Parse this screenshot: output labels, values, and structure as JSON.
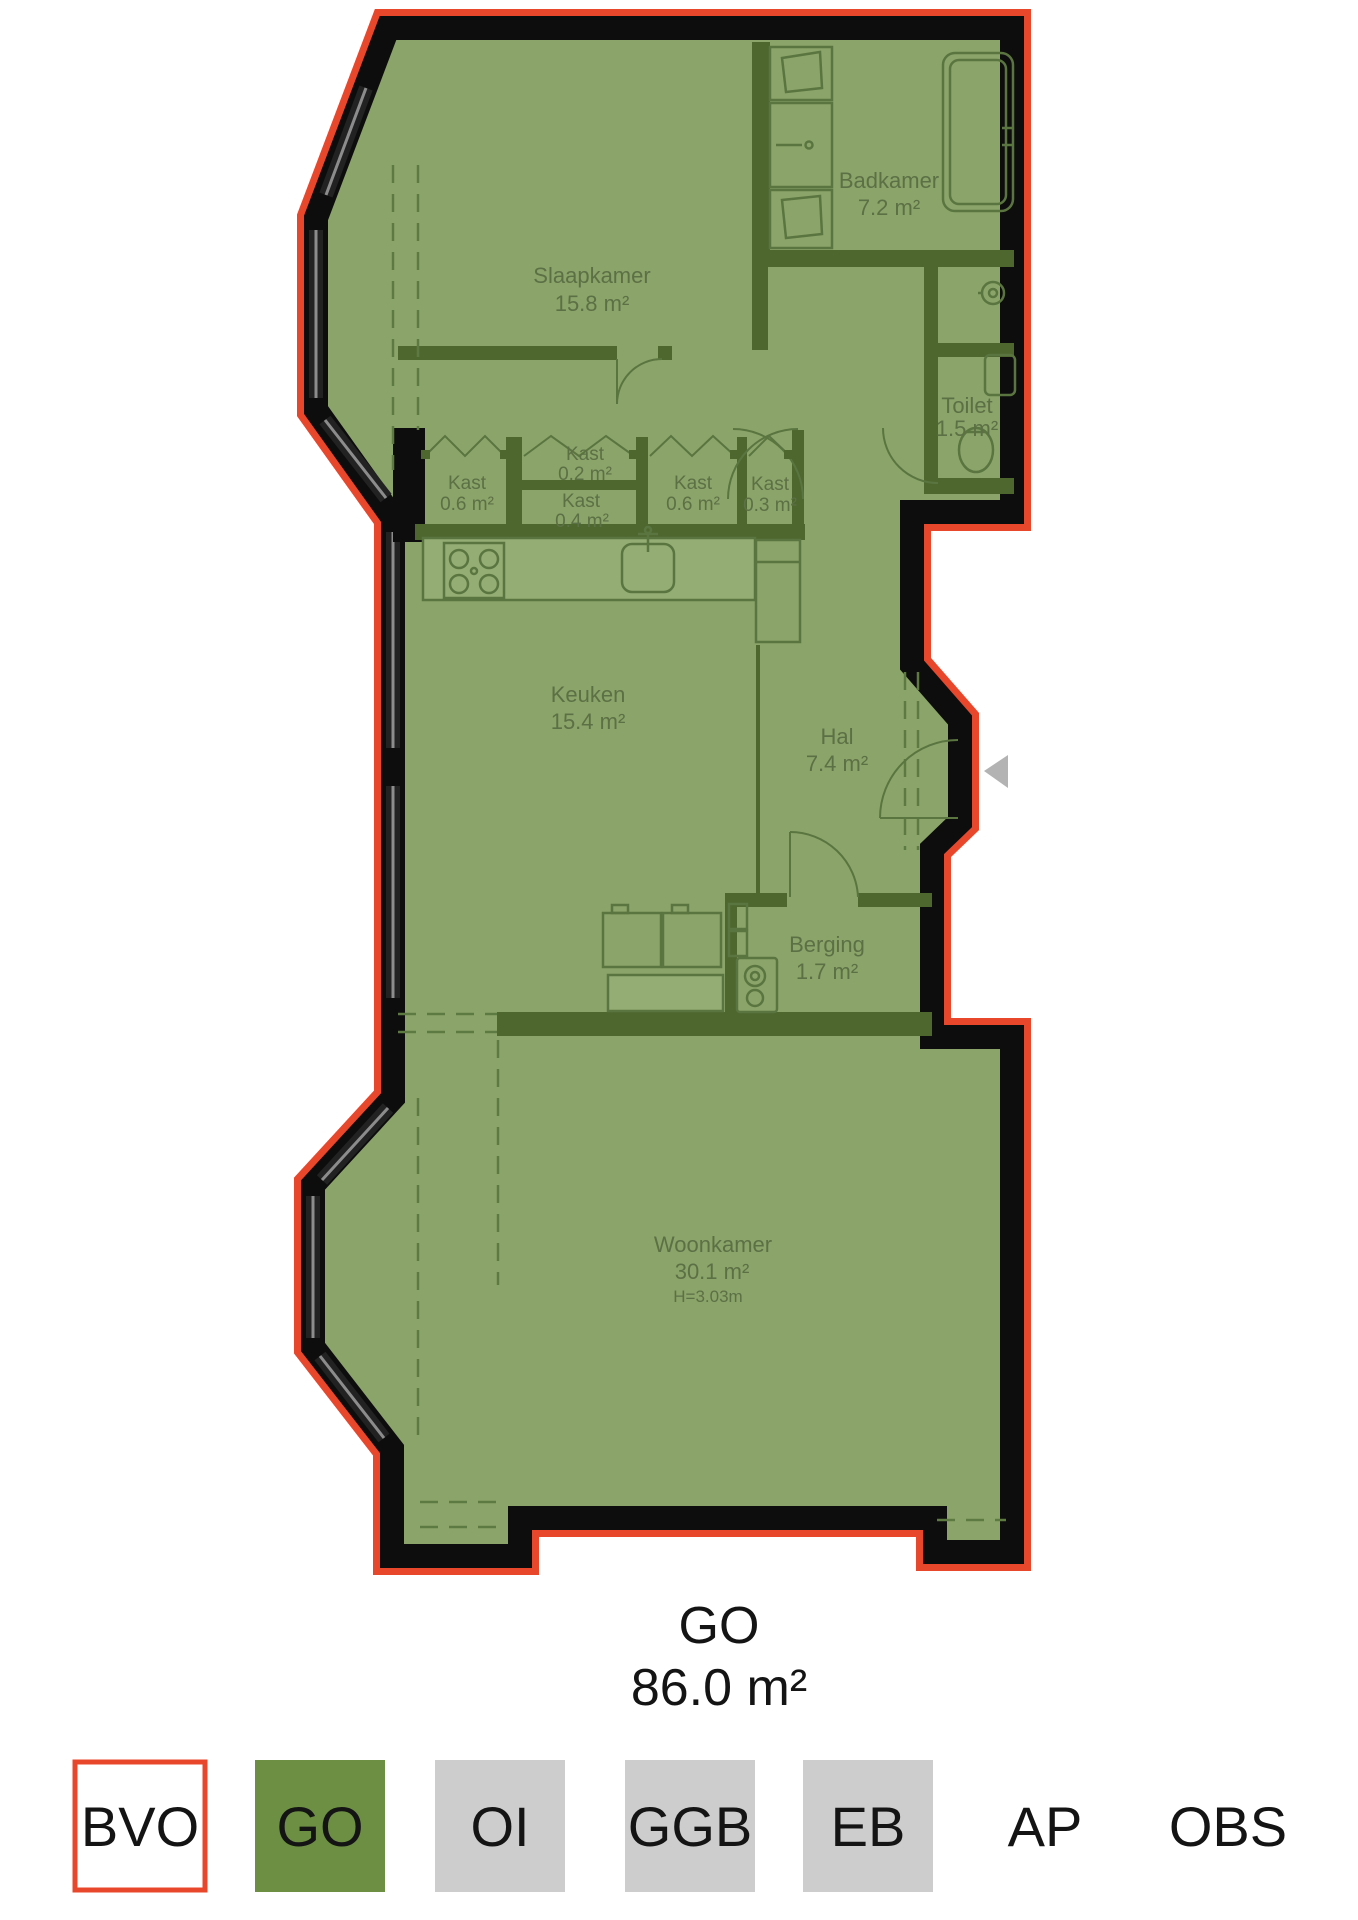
{
  "title": {
    "label": "GO",
    "value": "86.0 m²"
  },
  "rooms": {
    "slaapkamer": {
      "name": "Slaapkamer",
      "area": "15.8 m²"
    },
    "badkamer": {
      "name": "Badkamer",
      "area": "7.2 m²"
    },
    "toilet": {
      "name": "Toilet",
      "area": "1.5 m²"
    },
    "kast1": {
      "name": "Kast",
      "area": "0.6 m²"
    },
    "kast2": {
      "name": "Kast",
      "area": "0.2 m²"
    },
    "kast3": {
      "name": "Kast",
      "area": "0.4 m²"
    },
    "kast4": {
      "name": "Kast",
      "area": "0.6 m²"
    },
    "kast5": {
      "name": "Kast",
      "area": "0.3 m²"
    },
    "keuken": {
      "name": "Keuken",
      "area": "15.4 m²"
    },
    "hal": {
      "name": "Hal",
      "area": "7.4 m²"
    },
    "berging": {
      "name": "Berging",
      "area": "1.7 m²"
    },
    "woonkamer": {
      "name": "Woonkamer",
      "area": "30.1 m²",
      "ceiling_height": "H=3.03m"
    }
  },
  "legend": {
    "items": [
      {
        "code": "BVO",
        "swatch": "outlined-red"
      },
      {
        "code": "GO",
        "swatch": "green"
      },
      {
        "code": "OI",
        "swatch": "gray"
      },
      {
        "code": "GGB",
        "swatch": "gray"
      },
      {
        "code": "EB",
        "swatch": "gray"
      },
      {
        "code": "AP",
        "swatch": "none"
      },
      {
        "code": "OBS",
        "swatch": "none"
      }
    ]
  },
  "colors": {
    "outline_red": "#e8472b",
    "go_fill": "#8ba46a",
    "legend_green": "#6d8f43",
    "legend_gray": "#cdcdcd",
    "wall_black": "#0d0d0d",
    "interior_wall": "#4e672f"
  }
}
